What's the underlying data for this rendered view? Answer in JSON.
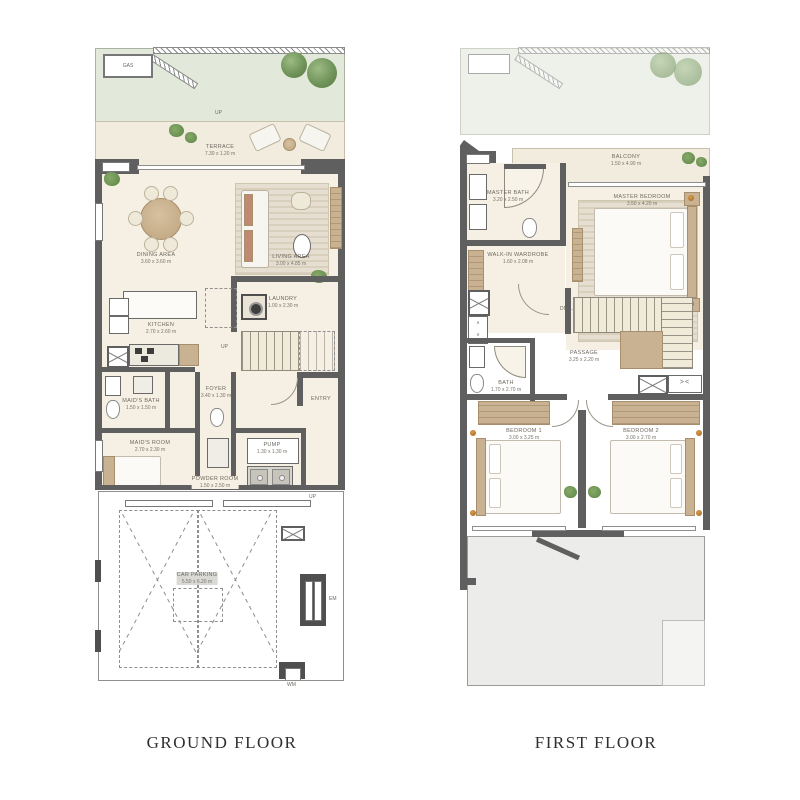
{
  "titles": {
    "ground": "GROUND FLOOR",
    "first": "FIRST FLOOR"
  },
  "ground_floor": {
    "gas_label": "GAS",
    "up_garden": "UP",
    "up_stairs": "UP",
    "up_parking": "UP",
    "em_label": "EM",
    "wm_label": "WM",
    "rooms": {
      "terrace": {
        "name": "TERRACE",
        "dims": "7.30 x 1.20 m"
      },
      "dining": {
        "name": "DINING AREA",
        "dims": "3.60 x 3.60 m"
      },
      "living": {
        "name": "LIVING AREA",
        "dims": "3.00 x 4.85 m"
      },
      "kitchen": {
        "name": "KITCHEN",
        "dims": "2.70 x 2.60 m"
      },
      "laundry": {
        "name": "LAUNDRY",
        "dims": "1.00 x 2.30 m"
      },
      "foyer": {
        "name": "FOYER",
        "dims": "3.40 x 1.30 m"
      },
      "entry": {
        "name": "ENTRY"
      },
      "maids_bath": {
        "name": "MAID'S BATH",
        "dims": "1.50 x 1.50 m"
      },
      "maids_room": {
        "name": "MAID'S ROOM",
        "dims": "2.70 x 2.30 m"
      },
      "powder": {
        "name": "POWDER ROOM",
        "dims": "1.50 x 2.50 m"
      },
      "pump": {
        "name": "PUMP",
        "dims": "1.30 x 1.30 m"
      },
      "parking": {
        "name": "CAR PARKING",
        "dims": "5.50 x 6.20 m"
      }
    }
  },
  "first_floor": {
    "dn_label": "DN",
    "rooms": {
      "balcony": {
        "name": "BALCONY",
        "dims": "1.50 x 4.90 m"
      },
      "master_bath": {
        "name": "MASTER BATH",
        "dims": "3.20 x 2.50 m"
      },
      "master_bedroom": {
        "name": "MASTER BEDROOM",
        "dims": "3.50 x 4.20 m"
      },
      "wardrobe": {
        "name": "WALK-IN WARDROBE",
        "dims": "1.60 x 2.08 m"
      },
      "bath": {
        "name": "BATH",
        "dims": "1.70 x 2.70 m"
      },
      "passage": {
        "name": "PASSAGE",
        "dims": "3.25 x 2.20 m"
      },
      "bedroom1": {
        "name": "BEDROOM 1",
        "dims": "3.00 x 3.25 m"
      },
      "bedroom2": {
        "name": "BEDROOM 2",
        "dims": "3.00 x 2.70 m"
      }
    }
  },
  "colors": {
    "wall": "#5f5f5f",
    "floor_cream": "#f5f0e3",
    "terrace_beige": "#f2ecdf",
    "garden_green": "#e3e9da",
    "parking_gray": "#d9d9d6",
    "roof_gray": "#ececea",
    "wood": "#c9b292",
    "plant_green": "#6d9157",
    "lamp_orange": "#b97a3d"
  }
}
